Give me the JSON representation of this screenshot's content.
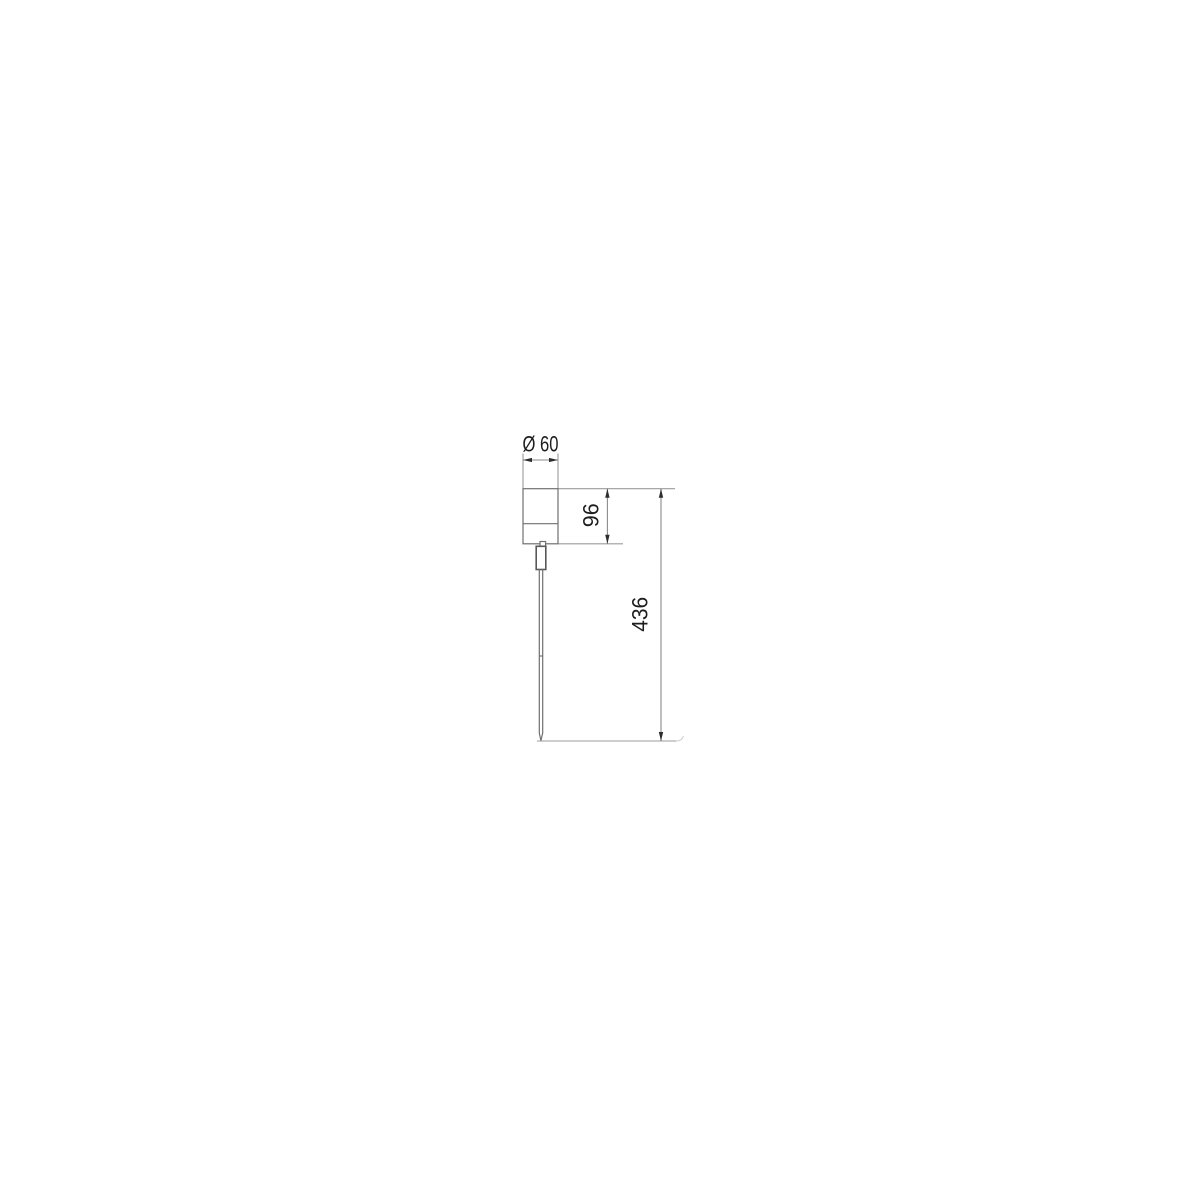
{
  "page": {
    "background": "#ffffff"
  },
  "drawing": {
    "labels": {
      "diameter": "Ø 60",
      "body_height": "96",
      "overall_height": "436"
    },
    "colors": {
      "background": "#ffffff",
      "extension_line": "#9b9b9b",
      "dimension_line": "#8a8a8a",
      "object_line": "#707070",
      "arrow": "#2e2e2e",
      "text": "#1d1d1d"
    }
  }
}
